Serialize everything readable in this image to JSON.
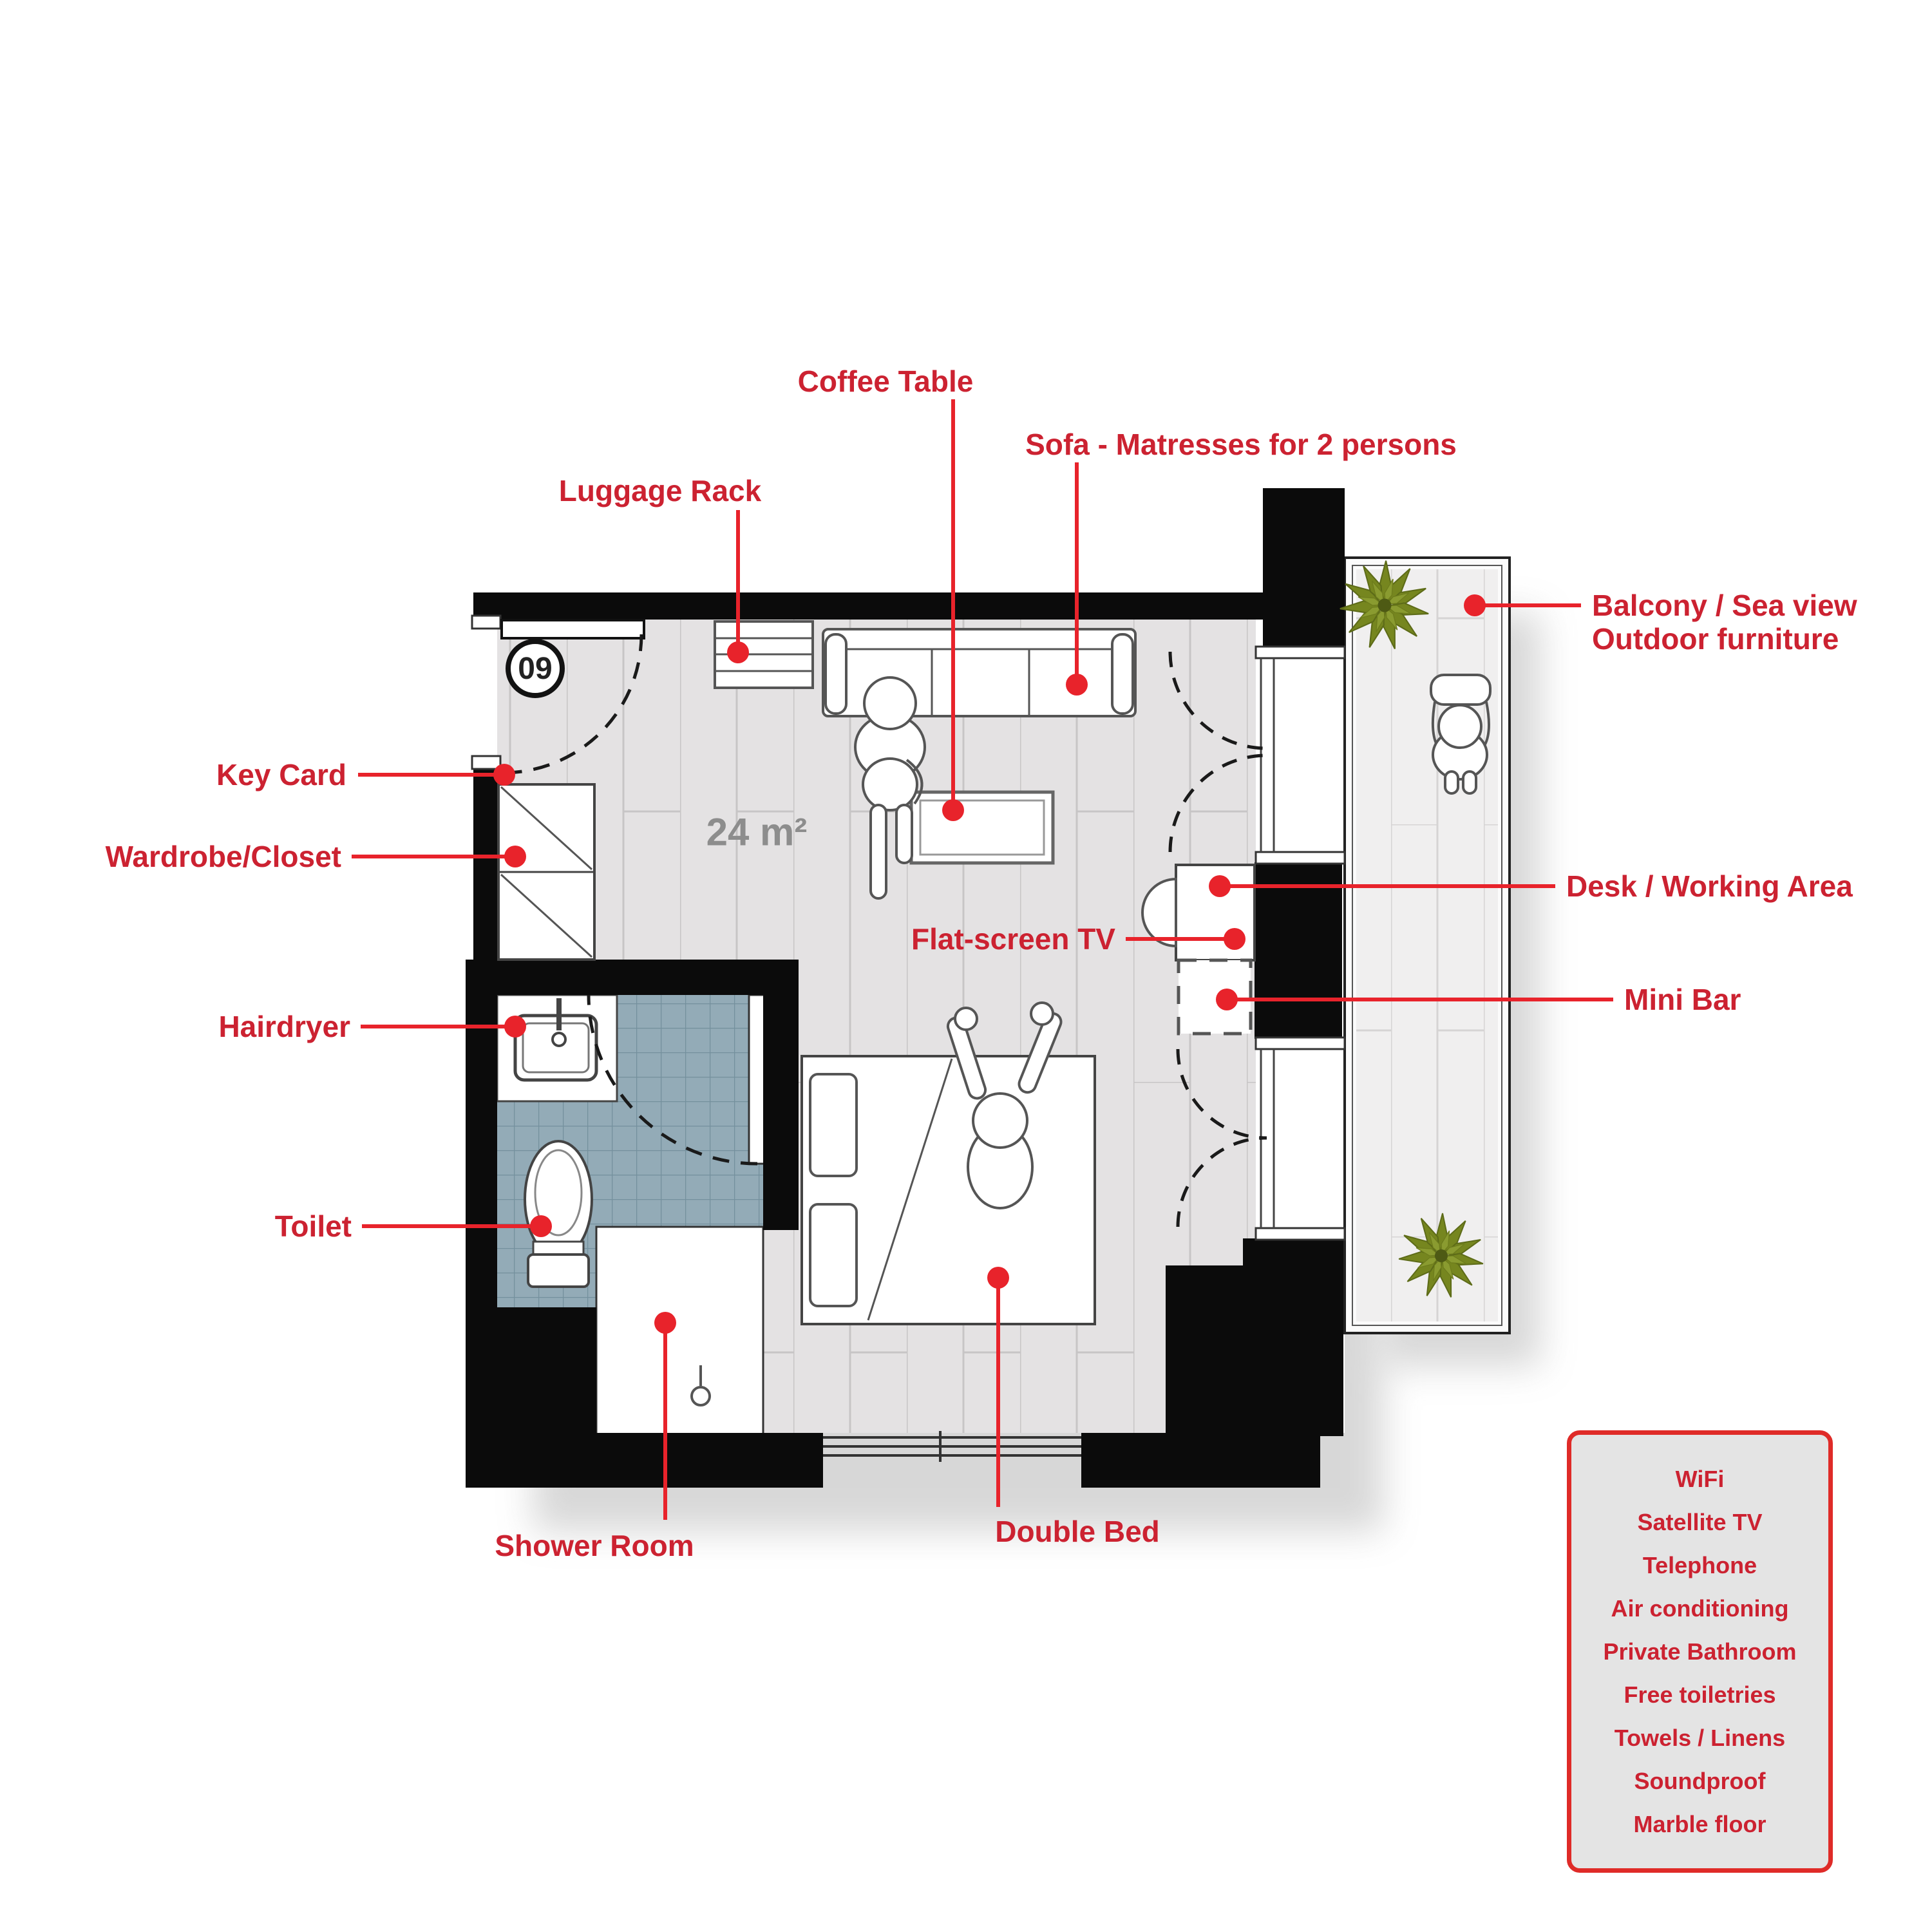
{
  "plan": {
    "room_number": "09",
    "area_label": "24 m²"
  },
  "labels": {
    "coffee_table": "Coffee Table",
    "sofa": "Sofa - Matresses for 2 persons",
    "luggage_rack": "Luggage Rack",
    "balcony_line1": "Balcony / Sea view",
    "balcony_line2": "Outdoor furniture",
    "key_card": "Key Card",
    "wardrobe": "Wardrobe/Closet",
    "desk": "Desk / Working Area",
    "flat_screen_tv": "Flat-screen TV",
    "mini_bar": "Mini Bar",
    "hairdryer": "Hairdryer",
    "toilet": "Toilet",
    "shower_room": "Shower Room",
    "double_bed": "Double Bed"
  },
  "legend": {
    "items": [
      "WiFi",
      "Satellite TV",
      "Telephone",
      "Air conditioning",
      "Private Bathroom",
      "Free toiletries",
      "Towels / Linens",
      "Soundproof",
      "Marble floor"
    ]
  },
  "colors": {
    "accent_red": "#e8232b",
    "label_red": "#cc2231",
    "wall_black": "#0b0b0b",
    "room_floor": "#e4e2e3",
    "bathroom_tile": "#93abb7",
    "balcony_floor": "#f0efef",
    "plant_green": "#76861f",
    "legend_bg": "#e4e4e4"
  }
}
